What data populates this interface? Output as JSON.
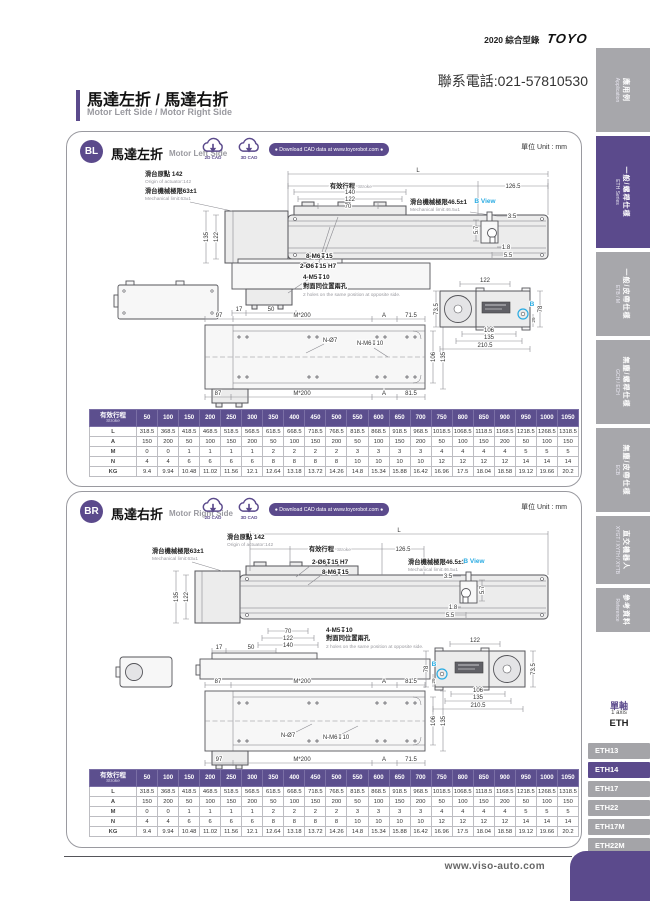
{
  "page": {
    "catalog": "2020 綜合型錄",
    "brand": "TOYO",
    "phone": "聯系電話:021-57810530",
    "title_zh": "馬達左折 / 馬達右折",
    "title_en": "Motor Left Side / Motor Right Side",
    "footer_url": "www.viso-auto.com"
  },
  "sidebar": {
    "tabs": [
      {
        "zh": "應用例",
        "en": "Application"
      },
      {
        "zh": "一般/螺桿仕樣",
        "en": "ETH Series"
      },
      {
        "zh": "一般/皮帶仕樣",
        "en": "ETB / M"
      },
      {
        "zh": "無塵/螺桿仕樣",
        "en": "GCH / ECH"
      },
      {
        "zh": "無塵/皮帶仕樣",
        "en": "ECB"
      },
      {
        "zh": "直交機器人",
        "en": "XYGT / XYTH / XYTB"
      },
      {
        "zh": "參考資料",
        "en": "Reference"
      }
    ]
  },
  "series_nav": {
    "group_zh": "單軸",
    "group_en": "1 axis",
    "group_code": "ETH",
    "items": [
      "ETH13",
      "ETH14",
      "ETH17",
      "ETH22",
      "ETH17M",
      "ETH22M"
    ],
    "active": "ETH14"
  },
  "panels": {
    "bl": {
      "badge": "BL",
      "title_zh": "馬達左折",
      "title_en": "Motor Left Side",
      "cad_2d": "2D CAD",
      "cad_3d": "3D CAD",
      "cad_banner": "● Download CAD data at www.toyorobot.com ●",
      "unit": "單位 Unit : mm",
      "drawing": {
        "dimL": "L",
        "origin_zh": "滑台原點 142",
        "origin_en": "Origin of actuator:142",
        "stroke_zh": "有效行程",
        "stroke_en": "Stroke",
        "d1265": "126.5",
        "mech_a_zh": "滑台機械極限63±1",
        "mech_a_en": "Mechanical limit:63±1",
        "mech_b_zh": "滑台機械極限46.5±1",
        "mech_b_en": "Mechanical limit:46.5±1",
        "d140": "140",
        "d122": "122",
        "d70": "70",
        "v135": "135",
        "v122": "122",
        "m6": "8-M6↧15",
        "o6": "2-Ø6↧15 H7",
        "m5": "4-M5↧10",
        "holes_zh": "對面同位置兩孔",
        "holes_en": "2 holes on the same position at opposite side.",
        "d17": "17",
        "d50": "50",
        "bview": "B View",
        "b35": "3.5",
        "b57": "5.7",
        "b18": "1.8",
        "b55": "5.5",
        "bmark": "B",
        "e122": "122",
        "e735": "73.5",
        "e78": "78",
        "e29": "29",
        "e106": "106",
        "e135": "135",
        "e2105": "210.5",
        "bt1": "97",
        "bt2": "M*200",
        "bt3": "A",
        "bt4": "71.5",
        "nd7": "N-Ø7",
        "nm6": "N-M6↧10",
        "r106": "106",
        "r135": "135",
        "bb1": "87",
        "bb2": "M*200",
        "bb3": "A",
        "bb4": "81.5"
      }
    },
    "br": {
      "badge": "BR",
      "title_zh": "馬達右折",
      "title_en": "Motor Right Side",
      "cad_2d": "2D CAD",
      "cad_3d": "3D CAD",
      "cad_banner": "● Download CAD data at www.toyorobot.com ●",
      "unit": "單位 Unit : mm",
      "drawing": {
        "dimL": "L",
        "origin_zh": "滑台原點 142",
        "origin_en": "Origin of actuator:142",
        "stroke_zh": "有效行程",
        "stroke_en": "Stroke",
        "d1265": "126.5",
        "mech_a_zh": "滑台機械極限63±1",
        "mech_a_en": "Mechanical limit:63±1",
        "mech_b_zh": "滑台機械極限46.5±1",
        "mech_b_en": "Mechanical limit:46.5±1",
        "d140": "140",
        "d122": "122",
        "d70": "70",
        "v135": "135",
        "v122": "122",
        "m6": "8-M6↧15",
        "o6": "2-Ø6↧15 H7",
        "m5": "4-M5↧10",
        "holes_zh": "對面同位置兩孔",
        "holes_en": "2 holes on the same position at opposite side.",
        "d17": "17",
        "d50": "50",
        "bview": "B View",
        "b35": "3.5",
        "b57": "5.7",
        "b18": "1.8",
        "b55": "5.5",
        "bmark": "B",
        "e122": "122",
        "e735": "73.5",
        "e78": "78",
        "e29": "29",
        "e106": "106",
        "e135": "135",
        "e2105": "210.5",
        "bt1": "87",
        "bt2": "M*200",
        "bt3": "A",
        "bt4": "81.5",
        "nd7": "N-Ø7",
        "nm6": "N-M6↧10",
        "r106": "106",
        "r135": "135",
        "bb1": "97",
        "bb2": "M*200",
        "bb3": "A",
        "bb4": "71.5"
      }
    }
  },
  "dimension_table": {
    "stroke_zh": "有效行程",
    "stroke_en": "Stroke",
    "strokes": [
      "50",
      "100",
      "150",
      "200",
      "250",
      "300",
      "350",
      "400",
      "450",
      "500",
      "550",
      "600",
      "650",
      "700",
      "750",
      "800",
      "850",
      "900",
      "950",
      "1000",
      "1050"
    ],
    "rows": [
      {
        "label": "L",
        "values": [
          "318.5",
          "368.5",
          "418.5",
          "468.5",
          "518.5",
          "568.5",
          "618.5",
          "668.5",
          "718.5",
          "768.5",
          "818.5",
          "868.5",
          "918.5",
          "968.5",
          "1018.5",
          "1068.5",
          "1118.5",
          "1168.5",
          "1218.5",
          "1268.5",
          "1318.5"
        ]
      },
      {
        "label": "A",
        "values": [
          "150",
          "200",
          "50",
          "100",
          "150",
          "200",
          "50",
          "100",
          "150",
          "200",
          "50",
          "100",
          "150",
          "200",
          "50",
          "100",
          "150",
          "200",
          "50",
          "100",
          "150"
        ]
      },
      {
        "label": "M",
        "values": [
          "0",
          "0",
          "1",
          "1",
          "1",
          "1",
          "2",
          "2",
          "2",
          "2",
          "3",
          "3",
          "3",
          "3",
          "4",
          "4",
          "4",
          "4",
          "5",
          "5",
          "5"
        ]
      },
      {
        "label": "N",
        "values": [
          "4",
          "4",
          "6",
          "6",
          "6",
          "6",
          "8",
          "8",
          "8",
          "8",
          "10",
          "10",
          "10",
          "10",
          "12",
          "12",
          "12",
          "12",
          "14",
          "14",
          "14"
        ]
      },
      {
        "label": "KG",
        "values": [
          "9.4",
          "9.94",
          "10.48",
          "11.02",
          "11.56",
          "12.1",
          "12.64",
          "13.18",
          "13.72",
          "14.26",
          "14.8",
          "15.34",
          "15.88",
          "16.42",
          "16.96",
          "17.5",
          "18.04",
          "18.58",
          "19.12",
          "19.66",
          "20.2"
        ]
      }
    ]
  }
}
